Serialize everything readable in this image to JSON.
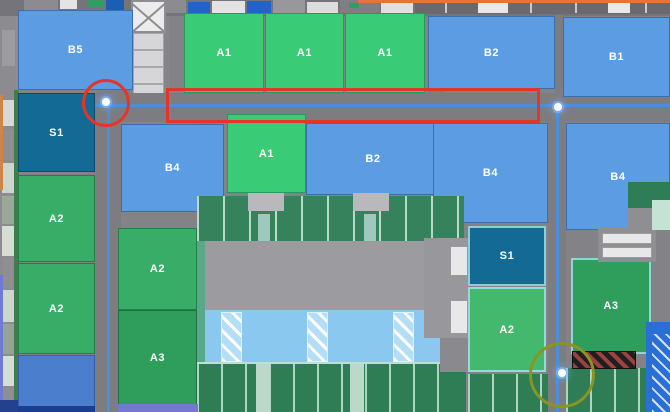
{
  "map": {
    "palette": {
      "block-blue": "#5b9ce2",
      "block-green-a1": "#3acb77",
      "block-green-a2": "#38ad67",
      "block-green-a2-light": "#43b96d",
      "block-green-a3": "#2f9e5c",
      "block-teal": "#136a94",
      "block-plain-blue": "#4b7ecd",
      "road": "#7d7d81",
      "road-line": "#4a8fd8",
      "orange-line": "#e0763c",
      "annotation-red": "#e53528",
      "annotation-olive": "#8a9422"
    },
    "blocks": [
      {
        "label": "B5",
        "type": "blue",
        "x": 18,
        "y": 10,
        "w": 115,
        "h": 80
      },
      {
        "label": "A1",
        "type": "green-a1",
        "x": 184,
        "y": 13,
        "w": 80,
        "h": 80
      },
      {
        "label": "A1",
        "type": "green-a1",
        "x": 265,
        "y": 13,
        "w": 79,
        "h": 80
      },
      {
        "label": "A1",
        "type": "green-a1",
        "x": 345,
        "y": 13,
        "w": 80,
        "h": 80
      },
      {
        "label": "B2",
        "type": "blue",
        "x": 428,
        "y": 16,
        "w": 127,
        "h": 73
      },
      {
        "label": "B1",
        "type": "blue",
        "x": 563,
        "y": 17,
        "w": 107,
        "h": 80
      },
      {
        "label": "S1",
        "type": "teal",
        "x": 18,
        "y": 93,
        "w": 77,
        "h": 79
      },
      {
        "label": "B4",
        "type": "blue",
        "x": 121,
        "y": 124,
        "w": 103,
        "h": 88
      },
      {
        "label": "A1",
        "type": "green-a1",
        "x": 227,
        "y": 114,
        "w": 79,
        "h": 79
      },
      {
        "label": "B2",
        "type": "blue",
        "x": 306,
        "y": 123,
        "w": 134,
        "h": 72
      },
      {
        "label": "B4",
        "type": "blue",
        "x": 433,
        "y": 123,
        "w": 115,
        "h": 100
      },
      {
        "label": "B4",
        "type": "blue",
        "x": 566,
        "y": 123,
        "w": 104,
        "h": 107
      },
      {
        "label": "A2",
        "type": "green-a2",
        "x": 18,
        "y": 175,
        "w": 77,
        "h": 87
      },
      {
        "label": "A2",
        "type": "green-a2",
        "x": 18,
        "y": 263,
        "w": 77,
        "h": 91
      },
      {
        "label": "",
        "type": "plain-blue",
        "x": 18,
        "y": 355,
        "w": 77,
        "h": 52
      },
      {
        "label": "A2",
        "type": "green-a2",
        "x": 118,
        "y": 228,
        "w": 79,
        "h": 82
      },
      {
        "label": "A3",
        "type": "green-a3",
        "x": 118,
        "y": 310,
        "w": 79,
        "h": 95
      },
      {
        "label": "S1",
        "type": "teal",
        "x": 468,
        "y": 226,
        "w": 78,
        "h": 60,
        "edge": "light"
      },
      {
        "label": "A2",
        "type": "green-a2-light",
        "x": 468,
        "y": 287,
        "w": 78,
        "h": 85,
        "edge": "light"
      },
      {
        "label": "A3",
        "type": "green-a3",
        "x": 571,
        "y": 258,
        "w": 80,
        "h": 96,
        "edge": "light"
      }
    ],
    "markers": [
      {
        "x": 106,
        "y": 102
      },
      {
        "x": 558,
        "y": 107
      },
      {
        "x": 562,
        "y": 373
      }
    ],
    "annotations": [
      {
        "shape": "circle",
        "cx": 106,
        "cy": 103,
        "r": 24,
        "color_key": "annotation-red"
      },
      {
        "shape": "rect",
        "x": 166,
        "y": 88,
        "w": 374,
        "h": 35,
        "color_key": "annotation-red"
      },
      {
        "shape": "circle",
        "cx": 562,
        "cy": 375,
        "r": 33,
        "color_key": "annotation-olive"
      }
    ]
  }
}
